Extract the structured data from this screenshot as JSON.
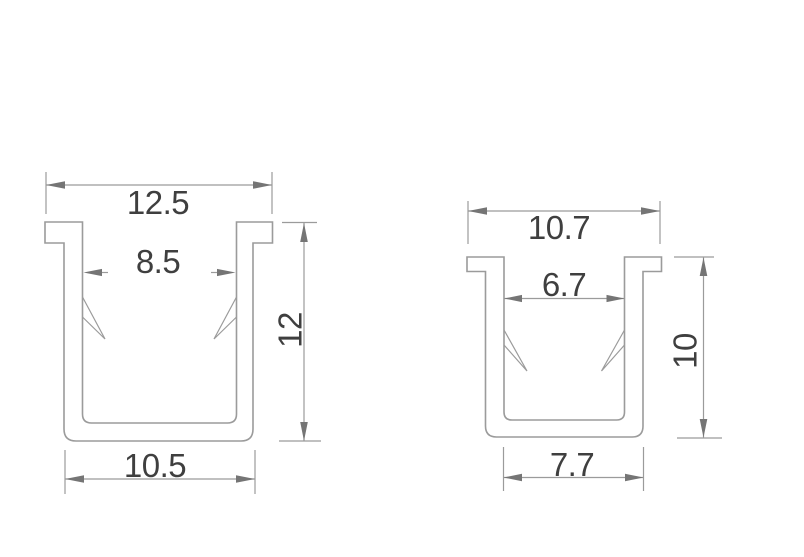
{
  "colors": {
    "background": "#ffffff",
    "outline": "#9b9b9b",
    "dimension": "#9b9b9b",
    "arrow": "#757575",
    "text": "#3f3f3f"
  },
  "diagram": {
    "type": "technical-drawing",
    "description": "Cross-sections of two U-channel profiles with dimension annotations",
    "profiles": [
      {
        "name": "left-profile",
        "top_width": "12.5",
        "inner_width": "8.5",
        "height": "12",
        "bottom_width": "10.5"
      },
      {
        "name": "right-profile",
        "top_width": "10.7",
        "inner_width": "6.7",
        "height": "10",
        "bottom_width": "7.7"
      }
    ]
  }
}
